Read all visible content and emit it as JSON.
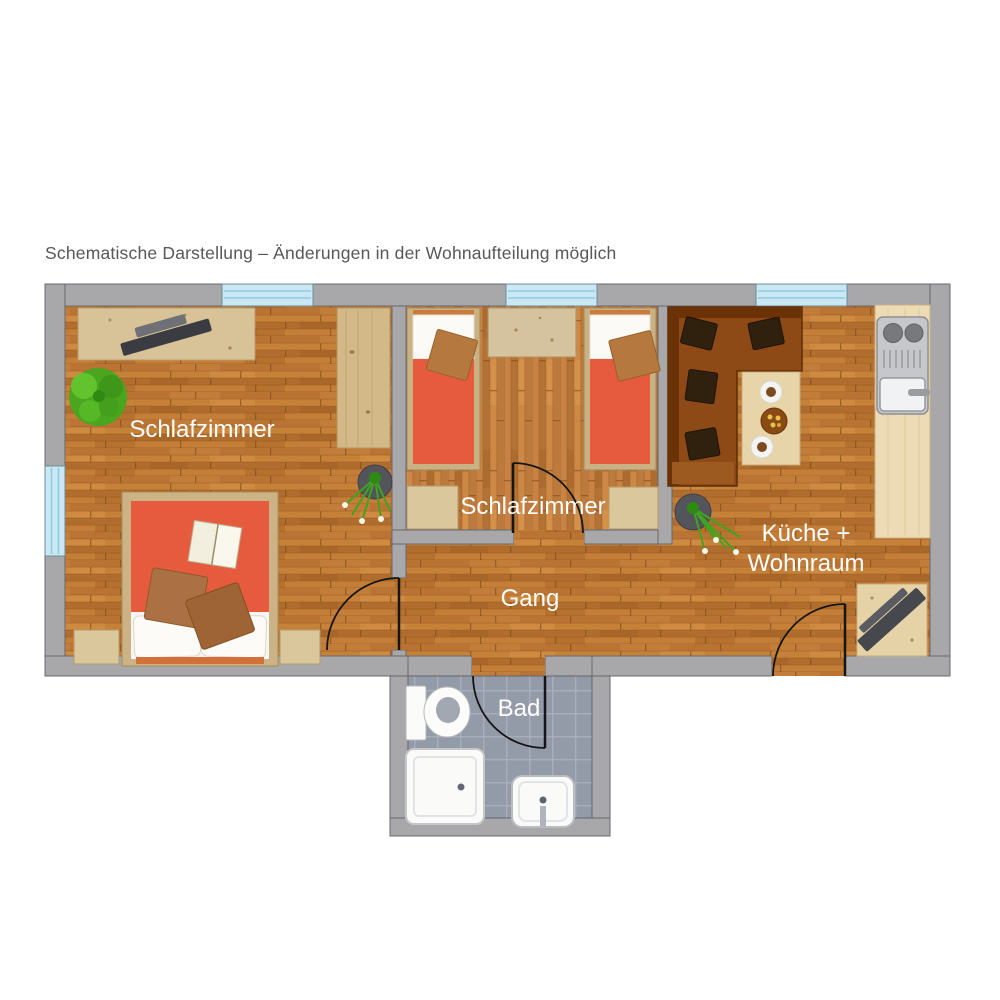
{
  "caption": "Schematische Darstellung – Änderungen in der Wohnaufteilung möglich",
  "rooms": {
    "bedroom_left": {
      "label": "Schlafzimmer"
    },
    "bedroom_middle": {
      "label": "Schlafzimmer"
    },
    "kitchen_living": {
      "label_line1": "Küche +",
      "label_line2": "Wohnraum"
    },
    "hallway": {
      "label": "Gang"
    },
    "bathroom": {
      "label": "Bad"
    }
  },
  "palette": {
    "wall": "#a8a8aa",
    "wall_outline": "#67696d",
    "window_glass": "#c9e8f4",
    "window_lines": "#8fcbdf",
    "wood_floor": "#c07b36",
    "bathroom_tile": "#939aa8",
    "bed_cover_red": "#e65a3d",
    "cushion_brown": "#ab7144",
    "sofa_brown": "#8e4a16",
    "furniture_wood": "#d8c297",
    "kitchen_steel": "#c6c7ca",
    "plant_green": "#3fa51e",
    "room_label": "#ffffff",
    "caption_text": "#57575a"
  }
}
